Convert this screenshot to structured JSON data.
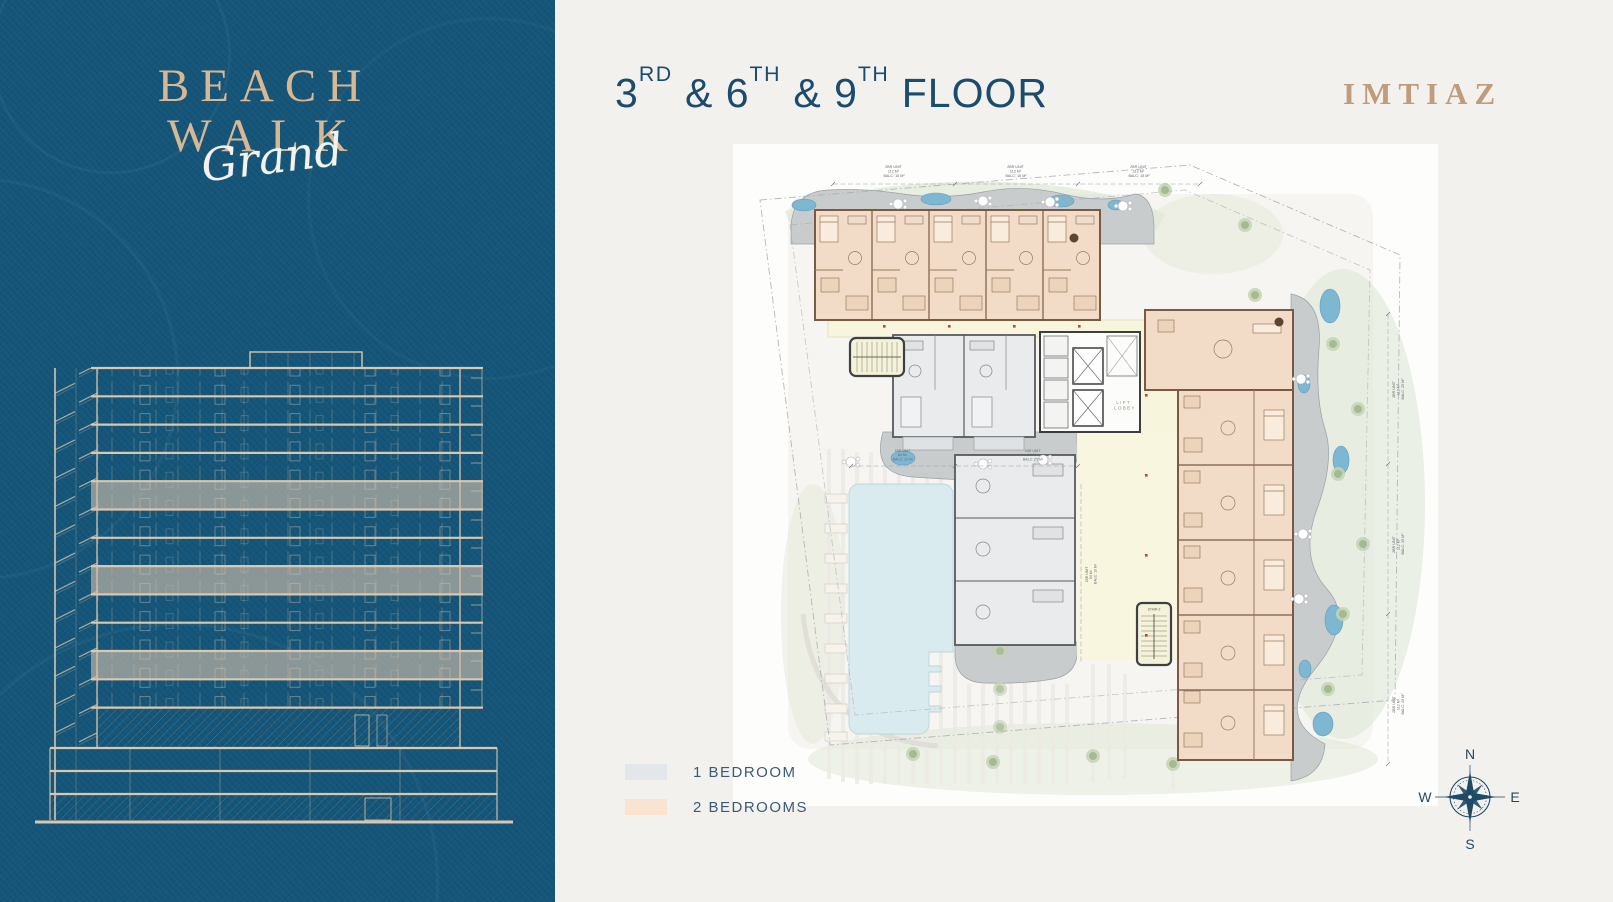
{
  "brand": {
    "name_line1": "BEACH",
    "name_line2": "WALK",
    "name_script": "Grand",
    "developer_logo": "IMTIAZ"
  },
  "header": {
    "floor_title_segments": [
      [
        "3",
        "RD"
      ],
      [
        " & 6",
        "TH"
      ],
      [
        " & 9",
        "TH"
      ],
      [
        " FLOOR",
        ""
      ]
    ]
  },
  "legend": {
    "items": [
      {
        "label": "1 BEDROOM",
        "color": "#e4e7ea"
      },
      {
        "label": "2 BEDROOMS",
        "color": "#fbe3d1"
      }
    ]
  },
  "compass": {
    "north": "N",
    "east": "E",
    "south": "S",
    "west": "W"
  },
  "plan": {
    "lift_lobby": [
      "LIFT",
      "LOBBY"
    ],
    "stair_label": "STAIR-2",
    "dims": {
      "top": [
        "2BR UNIT",
        "112 M²",
        "BALC: 15 M²"
      ],
      "right": [
        "2BR UNIT",
        "112 M²",
        "BALC: 25 M²"
      ],
      "pool_side": [
        "1BR UNIT",
        "64 M²",
        "BALC: 10 M²"
      ]
    }
  },
  "palette": {
    "teal_background": "#15567a",
    "gold": "#c2a081",
    "navy_text": "#1b4c6d",
    "unit_1br_fill": "#e9ebed",
    "unit_2br_fill": "#f2dcc8",
    "pool_fill": "#d9ebee",
    "water_feature": "#7db7d2",
    "deck_grey": "#c9cccd",
    "landscape_green": "#cfdcc3",
    "corridor_cream": "#f8f5dd"
  }
}
